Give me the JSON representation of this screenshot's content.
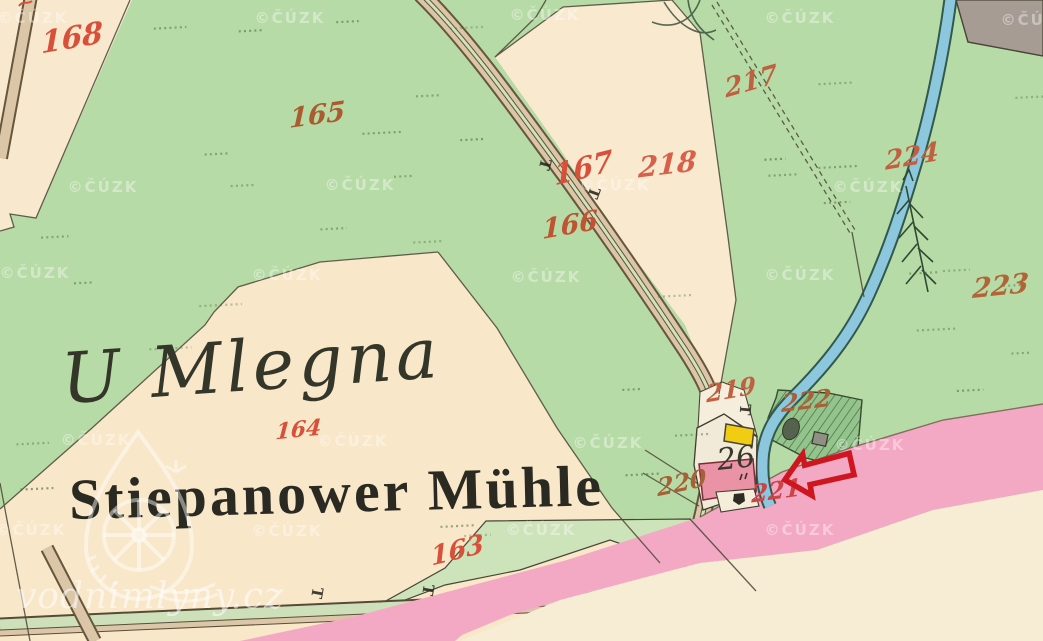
{
  "map_labels": {
    "place_name_script": "U Mlegna",
    "place_name_printed": "Stiepanower Mühle",
    "house_number": "26"
  },
  "parcel_numbers": [
    {
      "text": "168",
      "x": 72,
      "y": 48,
      "rot": -10,
      "size": 30,
      "color": "#d8503a"
    },
    {
      "text": "165",
      "x": 317,
      "y": 124,
      "rot": -8,
      "size": 27,
      "color": "#aa5c2e"
    },
    {
      "text": "167",
      "x": 584,
      "y": 178,
      "rot": -14,
      "size": 29,
      "color": "#d8503a"
    },
    {
      "text": "166",
      "x": 570,
      "y": 234,
      "rot": -10,
      "size": 27,
      "color": "#c05432"
    },
    {
      "text": "218",
      "x": 667,
      "y": 174,
      "rot": -7,
      "size": 28,
      "color": "#d8604a"
    },
    {
      "text": "217",
      "x": 752,
      "y": 90,
      "rot": -16,
      "size": 26,
      "color": "#c06040"
    },
    {
      "text": "224",
      "x": 912,
      "y": 165,
      "rot": -10,
      "size": 26,
      "color": "#c06040"
    },
    {
      "text": "223",
      "x": 1000,
      "y": 295,
      "rot": -6,
      "size": 27,
      "color": "#b06438"
    },
    {
      "text": "219",
      "x": 731,
      "y": 398,
      "rot": -10,
      "size": 24,
      "color": "#c06040"
    },
    {
      "text": "222",
      "x": 806,
      "y": 409,
      "rot": -7,
      "size": 24,
      "color": "#a86038"
    },
    {
      "text": "220",
      "x": 682,
      "y": 491,
      "rot": -12,
      "size": 24,
      "color": "#a86038"
    },
    {
      "text": "221",
      "x": 776,
      "y": 499,
      "rot": -8,
      "size": 24,
      "color": "#cc4448"
    },
    {
      "text": "164",
      "x": 298,
      "y": 437,
      "rot": -6,
      "size": 22,
      "color": "#d8503a"
    },
    {
      "text": "163",
      "x": 458,
      "y": 559,
      "rot": -14,
      "size": 26,
      "color": "#d8503a"
    }
  ],
  "t_marks": [
    {
      "x": 540,
      "y": 163,
      "rot": 105
    },
    {
      "x": 589,
      "y": 191,
      "rot": 110
    },
    {
      "x": 740,
      "y": 409,
      "rot": 95
    },
    {
      "x": 423,
      "y": 589,
      "rot": 100
    },
    {
      "x": 312,
      "y": 592,
      "rot": 100
    }
  ],
  "watermarks": {
    "text": "©ČÚZK",
    "positions": [
      [
        33,
        23
      ],
      [
        290,
        23
      ],
      [
        545,
        20
      ],
      [
        800,
        23
      ],
      [
        1036,
        25
      ],
      [
        103,
        192
      ],
      [
        360,
        190
      ],
      [
        615,
        190
      ],
      [
        868,
        192
      ],
      [
        35,
        278
      ],
      [
        287,
        280
      ],
      [
        546,
        282
      ],
      [
        800,
        280
      ],
      [
        96,
        445
      ],
      [
        353,
        446
      ],
      [
        608,
        448
      ],
      [
        870,
        450
      ],
      [
        31,
        535
      ],
      [
        287,
        536
      ],
      [
        541,
        535
      ],
      [
        800,
        535
      ]
    ]
  },
  "site_watermark": {
    "text": "vodnimlyny.cz"
  },
  "annotation_arrow": {
    "direction": "left",
    "color": "#ce1620"
  },
  "colors": {
    "meadow_green": "#b7dba6",
    "parcel_cream": "#f8e7c9",
    "parcel_cream_light": "#f7edd5",
    "road_fill": "#dbc6a8",
    "road_edge": "#66563d",
    "road_center_green": "#cfe2ba",
    "stream_blue": "#8cc7de",
    "stream_edge": "#31594c",
    "pink_road": "#f3a9c4",
    "gray_area": "#a69c94",
    "garden_green": "#93c48b",
    "yellow_building": "#f0cd12",
    "masonry_building": "#ea92a6",
    "ink": "#33362a",
    "boundary": "#4a4636"
  }
}
